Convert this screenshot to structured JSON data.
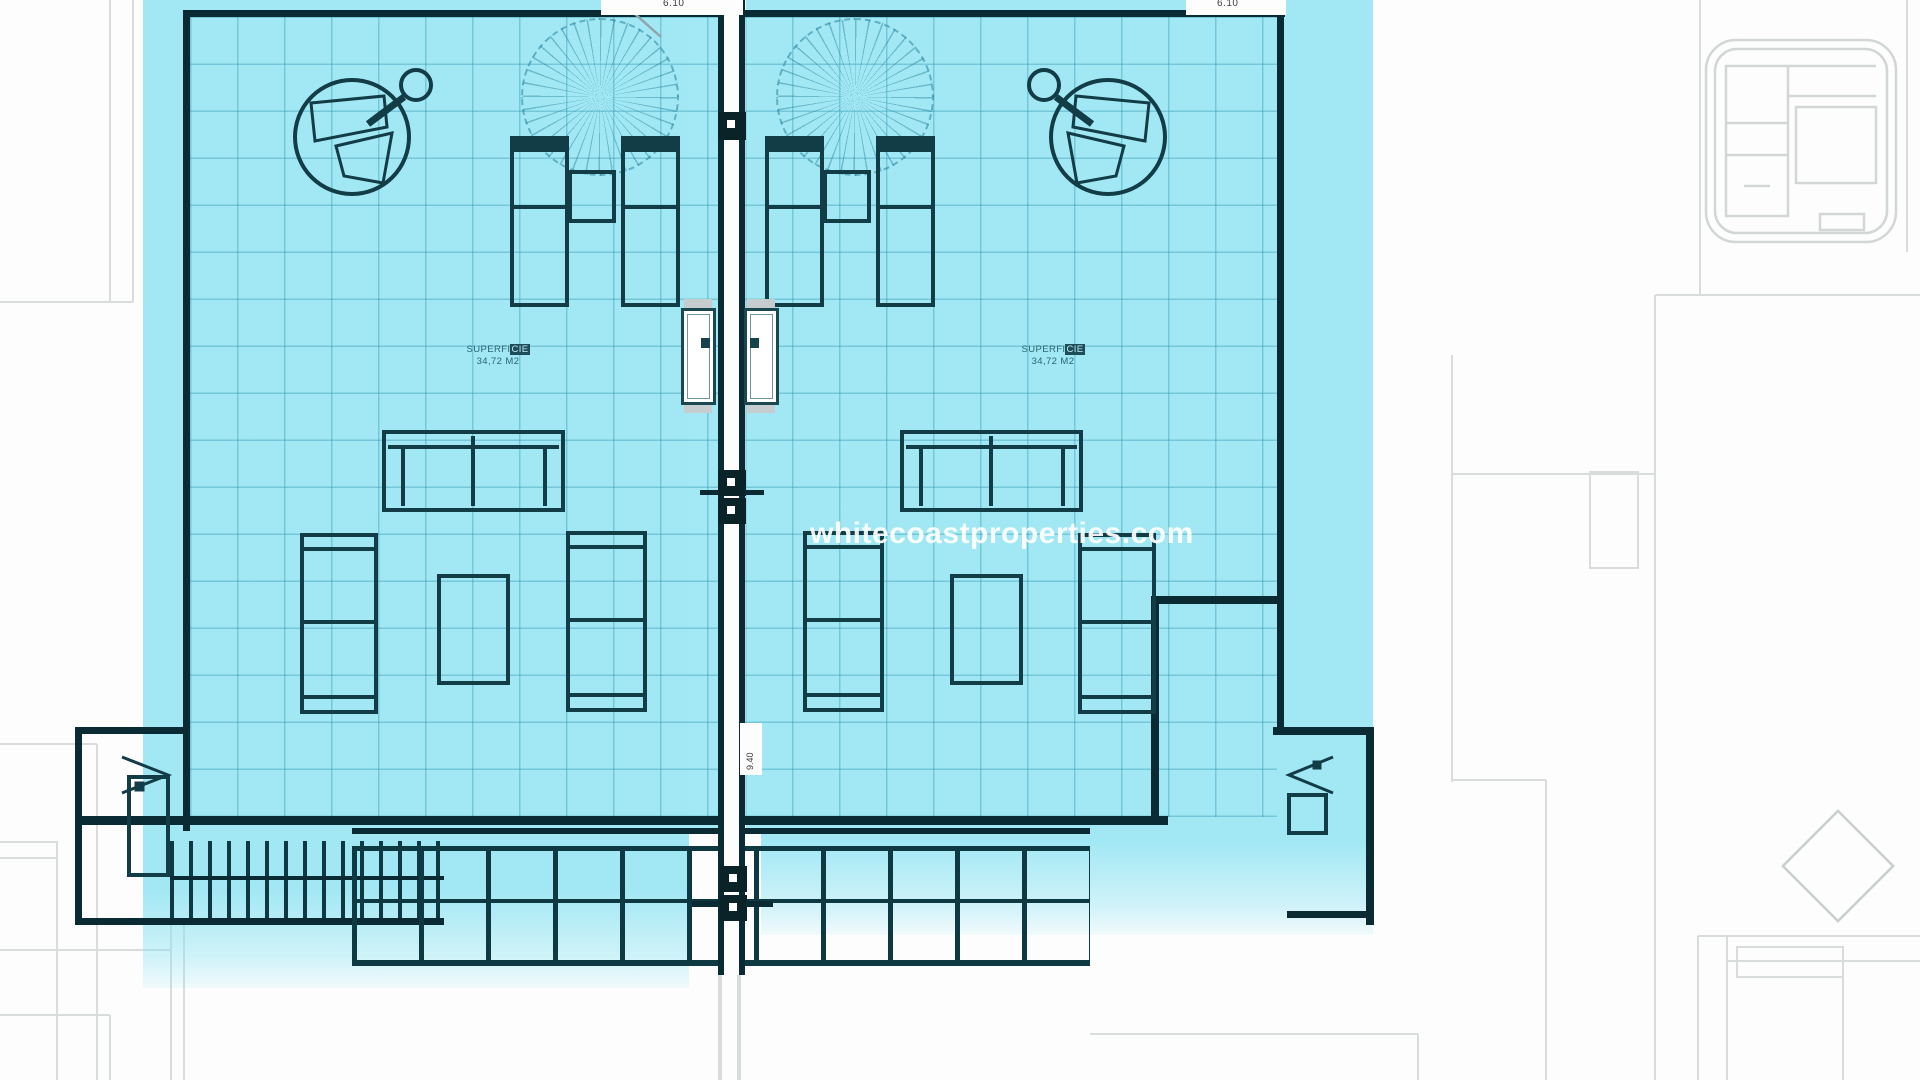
{
  "watermark": {
    "text": "whitecoastproperties.com",
    "color": "#ffffff"
  },
  "dimensions": {
    "width_left_label": "6.10",
    "width_right_label": "6.10",
    "depth_label": "9.40"
  },
  "units": {
    "left": {
      "area_line1_a": "SUPERFI",
      "area_line1_b": "CIE",
      "area_line2": "34,72 M2"
    },
    "right": {
      "area_line1_a": "SUPERFI",
      "area_line1_b": "CIE",
      "area_line2": "34,72 M2"
    }
  },
  "colors": {
    "highlight_cyan": "#88e2f2",
    "plan_line": "#123c46",
    "underlay_line": "#d8dcdc",
    "watermark_text": "#ffffff"
  }
}
